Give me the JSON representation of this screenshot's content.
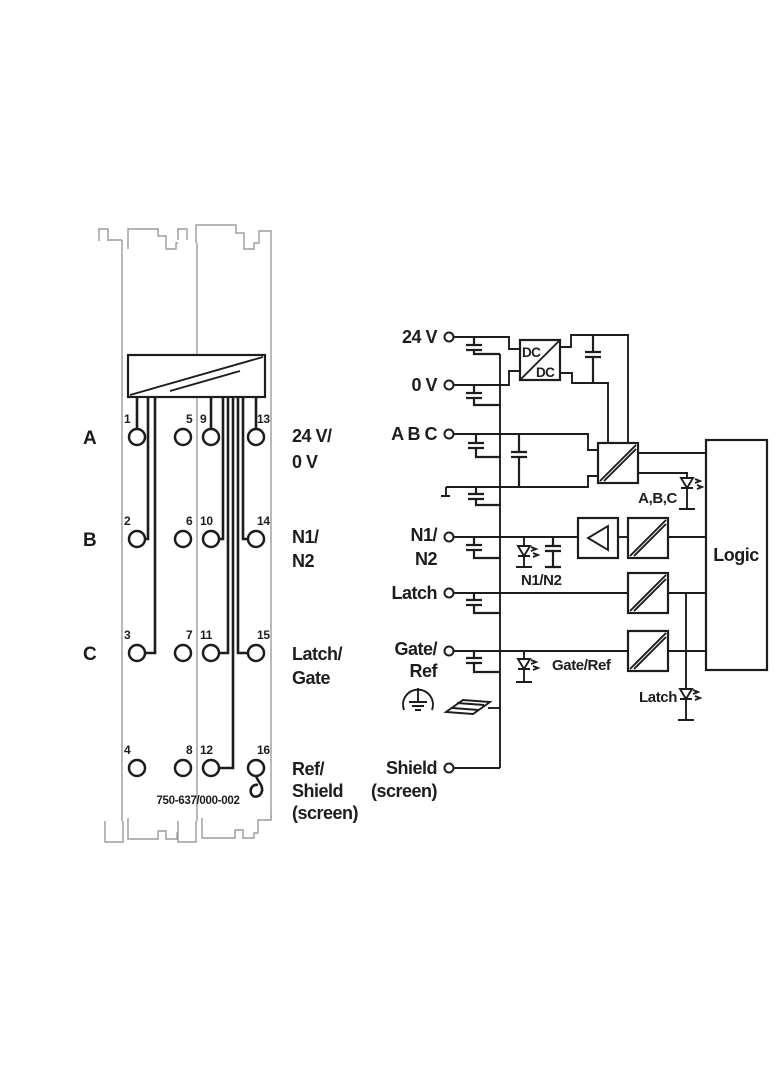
{
  "module": {
    "part_number": "750-637/000-002",
    "rows": [
      {
        "letter": "A",
        "numbers": [
          "1",
          "5",
          "9",
          "13"
        ],
        "label": [
          "24 V/",
          "0 V"
        ]
      },
      {
        "letter": "B",
        "numbers": [
          "2",
          "6",
          "10",
          "14"
        ],
        "label": [
          "N1/",
          "N2"
        ]
      },
      {
        "letter": "C",
        "numbers": [
          "3",
          "7",
          "11",
          "15"
        ],
        "label": [
          "Latch/",
          "Gate"
        ]
      },
      {
        "letter": "",
        "numbers": [
          "4",
          "8",
          "12",
          "16"
        ],
        "label": [
          "Ref/",
          "Shield",
          "(screen)"
        ]
      }
    ]
  },
  "schematic": {
    "inputs": {
      "v24": "24 V",
      "v0": "0 V",
      "abc": "A B C",
      "n1n2": [
        "N1/",
        "N2"
      ],
      "latch": "Latch",
      "gateref": [
        "Gate/",
        "Ref"
      ],
      "shield": [
        "Shield",
        "(screen)"
      ]
    },
    "dcdc": [
      "DC",
      "DC"
    ],
    "logic": "Logic",
    "leds": {
      "abc": "A,B,C",
      "n1n2": "N1/N2",
      "gateref": "Gate/Ref",
      "latch": "Latch"
    }
  },
  "colors": {
    "line": "#1d1d1b",
    "housing": "#9b9b9b",
    "background": "#ffffff"
  }
}
